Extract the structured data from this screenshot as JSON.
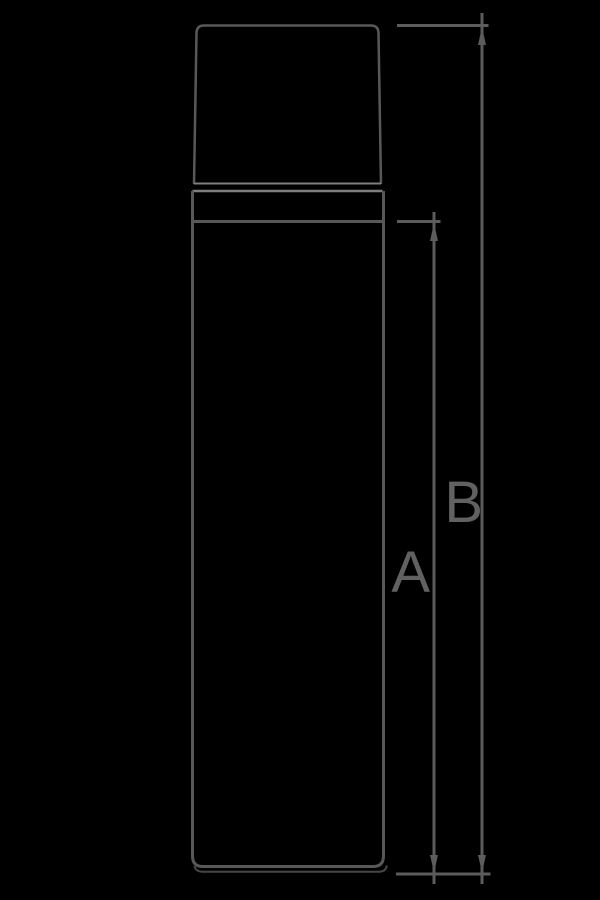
{
  "theme": {
    "background": "#000000",
    "outline": "#585858",
    "outline_light": "#7e7e7e",
    "outline_dark": "#474747",
    "dimension": "#5c5c5c",
    "label": "#616161"
  },
  "diagram": {
    "type": "technical-drawing",
    "subject": "bottle front elevation with height dimensions",
    "dimensions": {
      "a": {
        "label": "A"
      },
      "b": {
        "label": "B"
      }
    }
  }
}
